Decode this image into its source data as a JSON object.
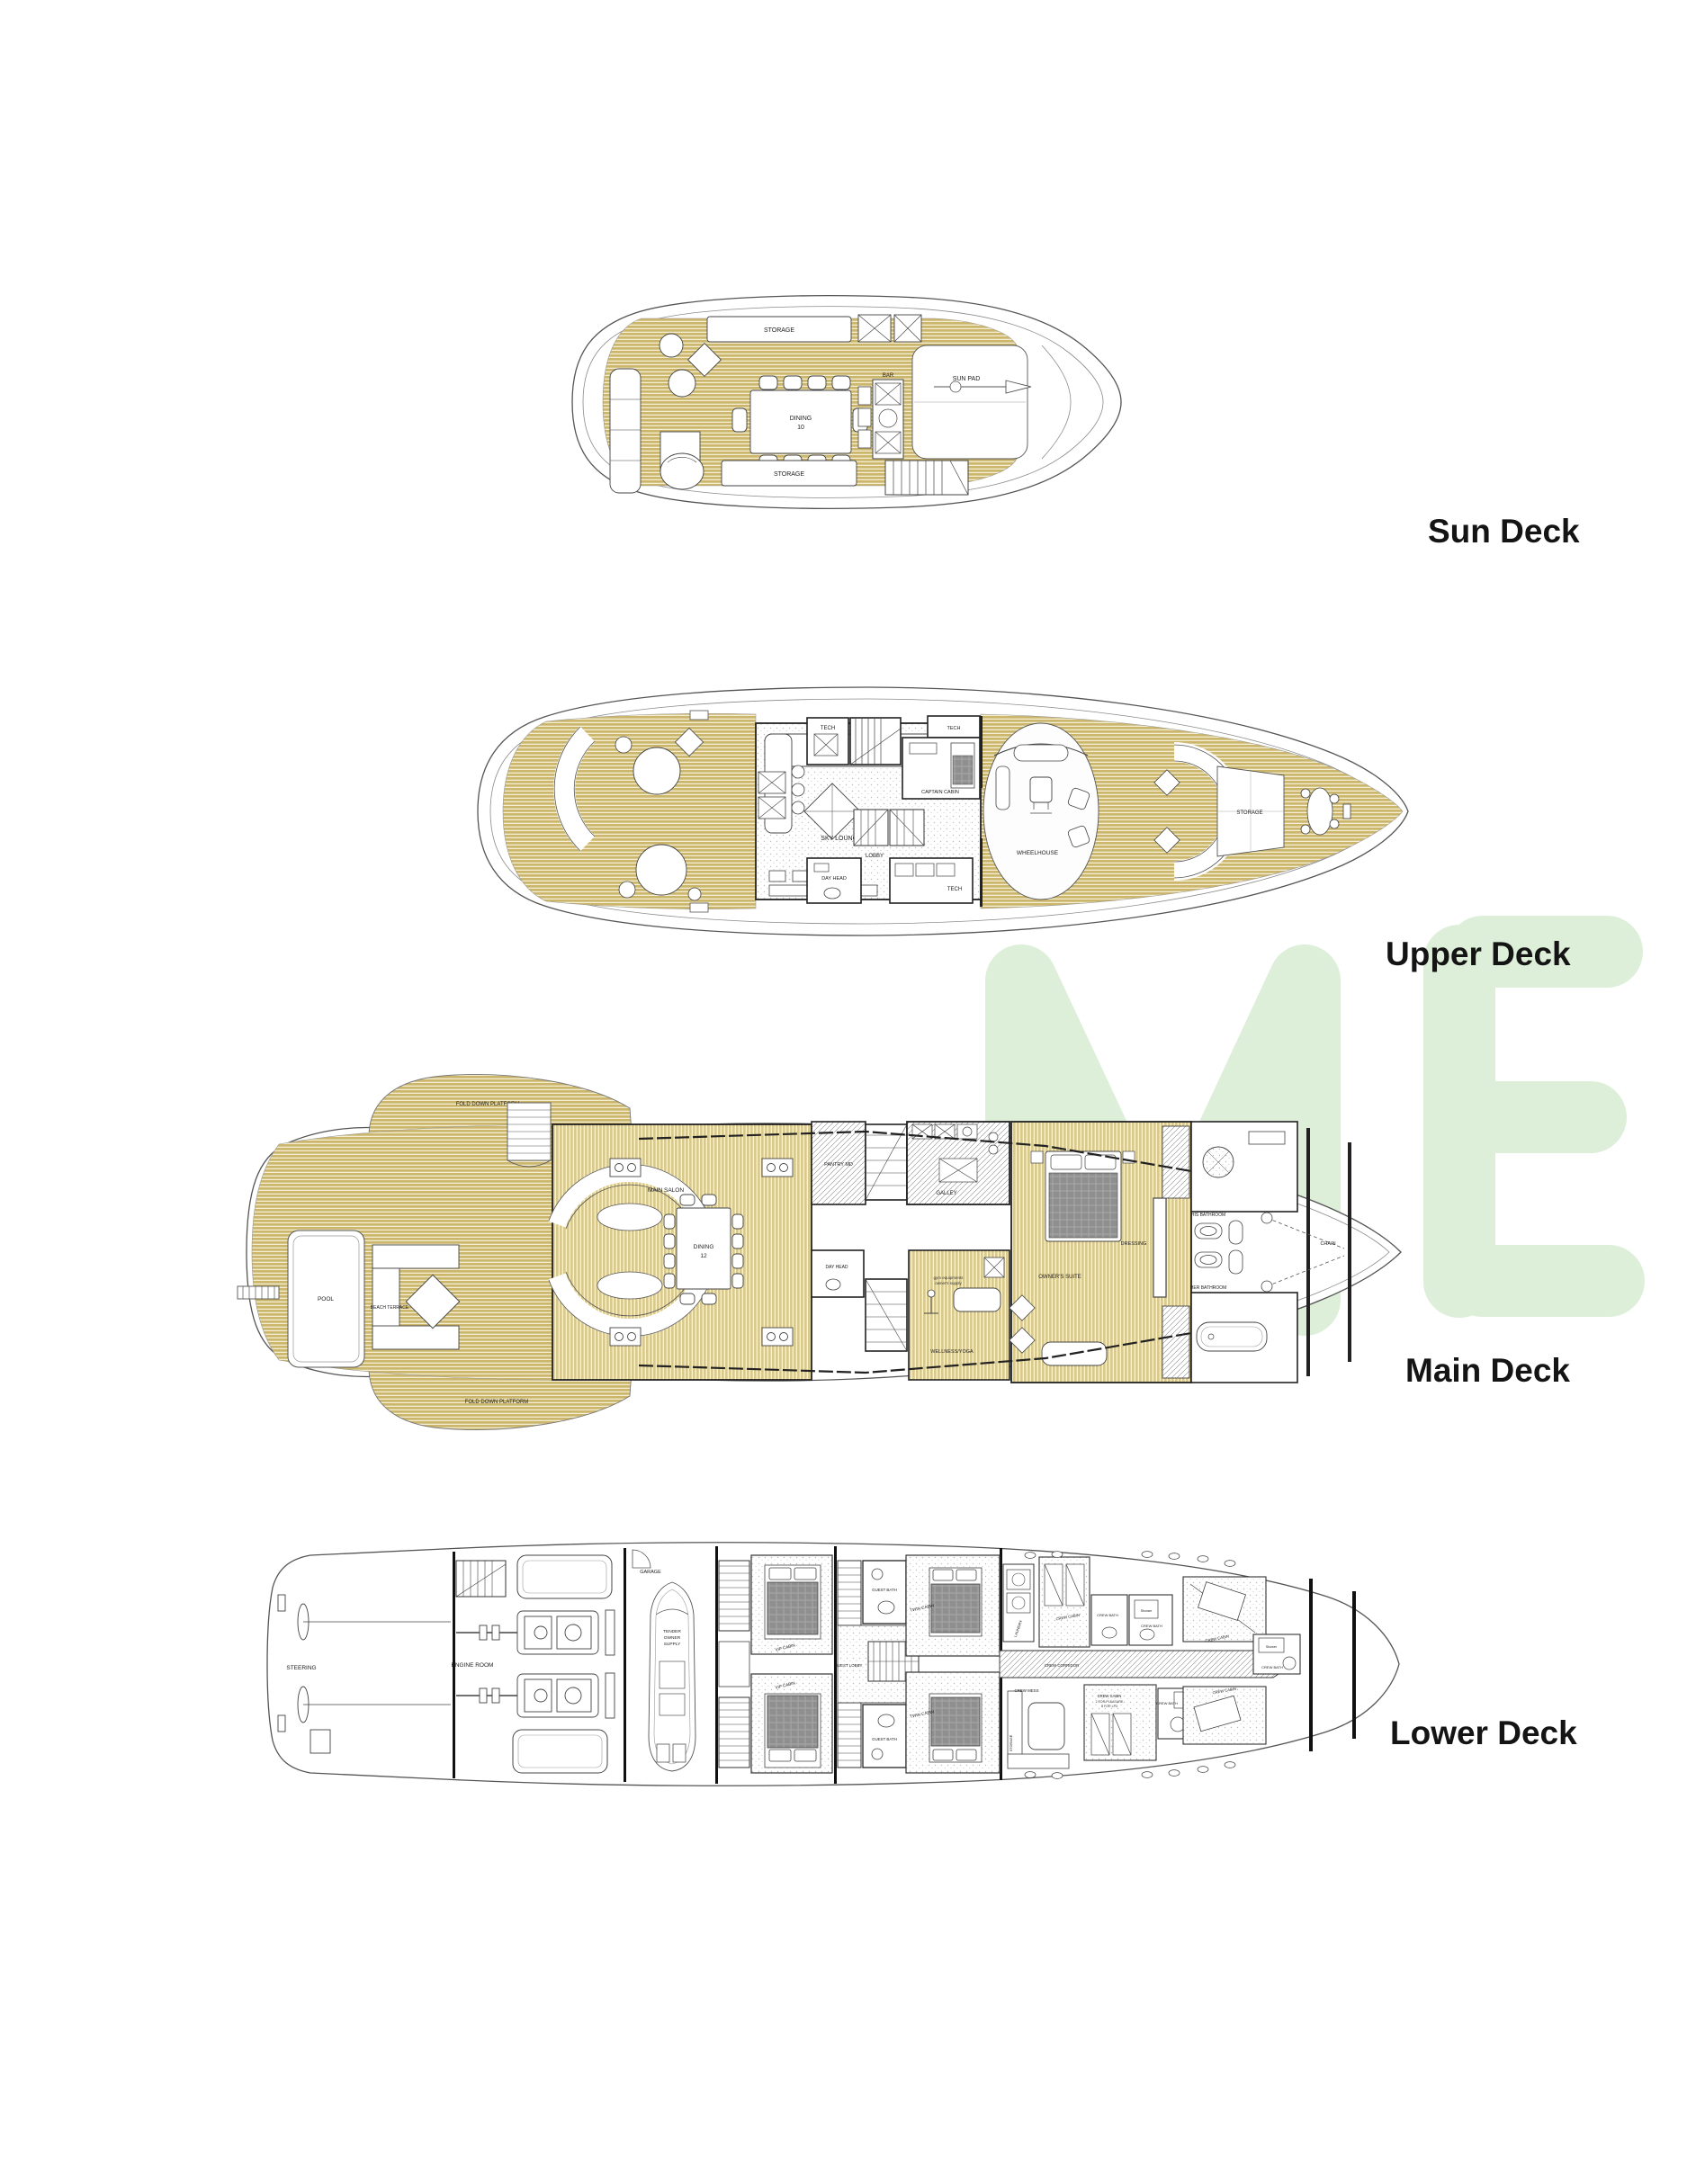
{
  "page": {
    "background": "#ffffff",
    "watermark": {
      "text": "ME",
      "color": "#ddefd9"
    }
  },
  "decks": {
    "sun": {
      "title": "Sun Deck",
      "rooms": {
        "storage": "STORAGE",
        "dining_line1": "DINING",
        "dining_line2": "10",
        "bar": "BAR",
        "sun_pad": "SUN PAD"
      }
    },
    "upper": {
      "title": "Upper Deck",
      "rooms": {
        "tech": "TECH",
        "sky_lounge": "SKY LOUNGE",
        "captain_cabin": "CAPTAIN CABIN",
        "lobby": "LOBBY",
        "day_head": "DAY HEAD",
        "wheelhouse": "WHEELHOUSE",
        "storage": "STORAGE"
      }
    },
    "main": {
      "title": "Main Deck",
      "rooms": {
        "fold_down_platform": "FOLD DOWN PLATFORM",
        "pool": "POOL",
        "beach_terrace": "BEACH TERRACE",
        "main_salon": "MAIN SALON",
        "dining_line1": "DINING",
        "dining_line2": "12",
        "galley": "GALLEY",
        "pantry": "PANTRY MD",
        "day_head": "DAY HEAD",
        "owners_suite": "OWNER'S SUITE",
        "dressing": "DRESSING",
        "his_bathroom": "HIS BATHROOM",
        "her_bathroom": "HER BATHROOM",
        "wellness_yoga": "WELLNESS/YOGA",
        "gym_line1": "gym equipments",
        "gym_line2": "owner's supply",
        "chain": "CHAIN"
      }
    },
    "lower": {
      "title": "Lower Deck",
      "rooms": {
        "steering": "STEERING",
        "engine_room": "ENGINE ROOM",
        "garage": "GARAGE",
        "tender_line1": "TENDER",
        "tender_line2": "OWNER",
        "tender_line3": "SUPPLY",
        "vip_cabin": "VIP CABIN",
        "guest_bath": "GUEST BATH",
        "twin_cabin": "TWIN CABIN",
        "guest_lobby": "GUEST LOBBY",
        "laundry": "LAUNDRY",
        "crew_corridor": "CREW CORRIDOR",
        "crew_mess": "CREW MESS",
        "crew_cabin": "CREW CABIN",
        "crew_note_line1": "2 FOR PLEASURE",
        "crew_note_line2": "8 FOR LP3",
        "crew_bath": "CREW BATH",
        "shower": "Shower",
        "storage": "STORAGE"
      }
    }
  }
}
